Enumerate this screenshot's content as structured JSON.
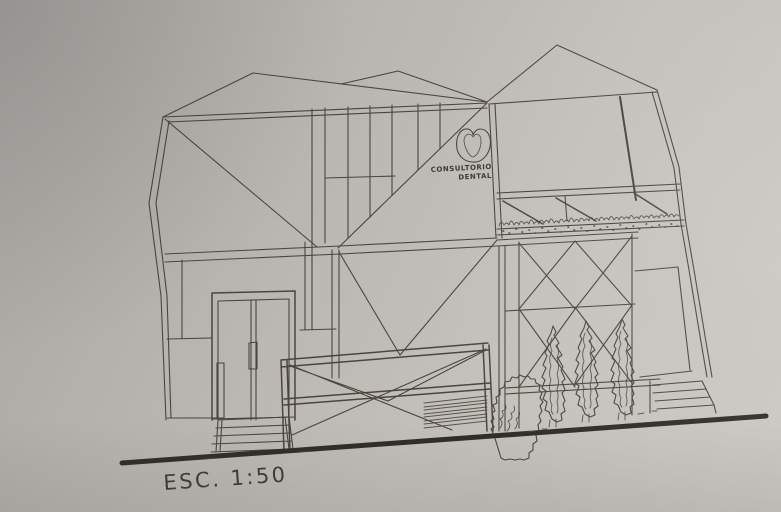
{
  "drawing": {
    "logo": {
      "line1": "CONSULTORIO",
      "line2": "DENTAL"
    },
    "scale_label": "ESC. 1:50"
  },
  "icons": {
    "logo": "tooth-outline-icon"
  },
  "colors": {
    "paper_dark": "#a8a5a2",
    "paper_light": "#cbc7c2",
    "ink": "#4a453f",
    "ink_bold": "#2f2c28"
  }
}
